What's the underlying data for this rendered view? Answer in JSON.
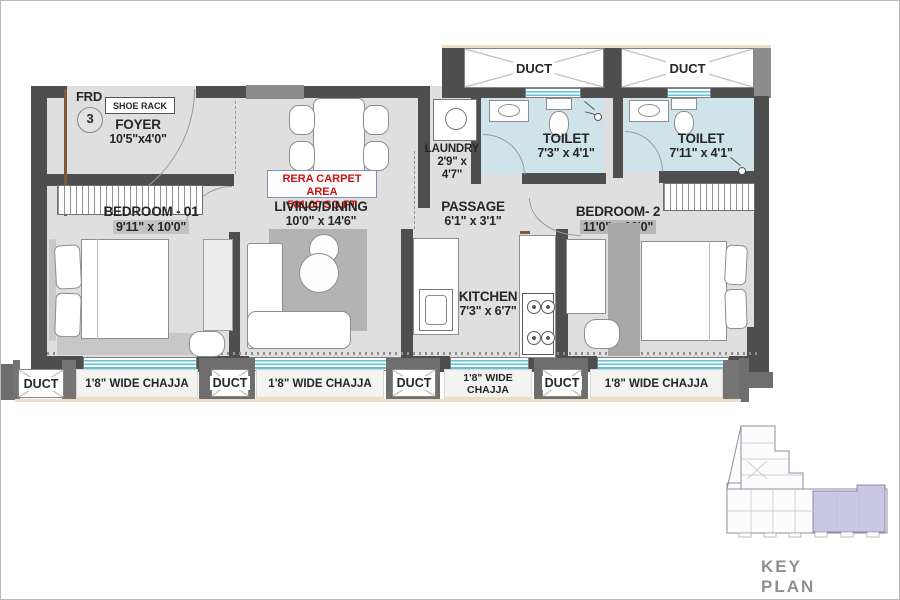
{
  "plan": {
    "entrance": {
      "frd": "FRD",
      "door_number": "3",
      "shoe_rack": "SHOE RACK"
    },
    "rera": {
      "line1": "RERA CARPET AREA",
      "line2": "581.00 SQ.FT"
    },
    "rooms": {
      "foyer": {
        "name": "FOYER",
        "dims": "10'5\"x4'0\""
      },
      "living_dining": {
        "name": "LIVING/DINING",
        "dims": "10'0\" x 14'6\""
      },
      "bedroom_1": {
        "name": "BEDROOM - 01",
        "dims": "9'11\" x 10'0\""
      },
      "bedroom_2": {
        "name": "BEDROOM- 2",
        "dims": "11'0\" x 10'0\""
      },
      "kitchen": {
        "name": "KITCHEN",
        "dims": "7'3\" x 6'7\""
      },
      "toilet_1": {
        "name": "TOILET",
        "dims": "7'3\" x 4'1\""
      },
      "toilet_2": {
        "name": "TOILET",
        "dims": "7'11\" x 4'1\""
      },
      "laundry": {
        "name": "LAUNDRY",
        "dims_line1": "2'9\" x",
        "dims_line2": "4'7\""
      },
      "passage": {
        "name": "PASSAGE",
        "dims": "6'1\" x 3'1\""
      }
    },
    "duct_label": "DUCT",
    "chajja_label": "1'8\" WIDE CHAJJA",
    "chajja_two_line": {
      "line1": "1'8\" WIDE",
      "line2": "CHAJJA"
    }
  },
  "key_plan": {
    "caption": "KEY PLAN"
  },
  "colors": {
    "wall_dark": "#4e4e4e",
    "wall_mid": "#8c8c8c",
    "floor": "#dfdfdf",
    "toilet_floor": "#cfe3ea",
    "window_blue": "#5fc3dc",
    "rera_red": "#cc1111",
    "keyplan_highlight": "#c9c7e4"
  }
}
